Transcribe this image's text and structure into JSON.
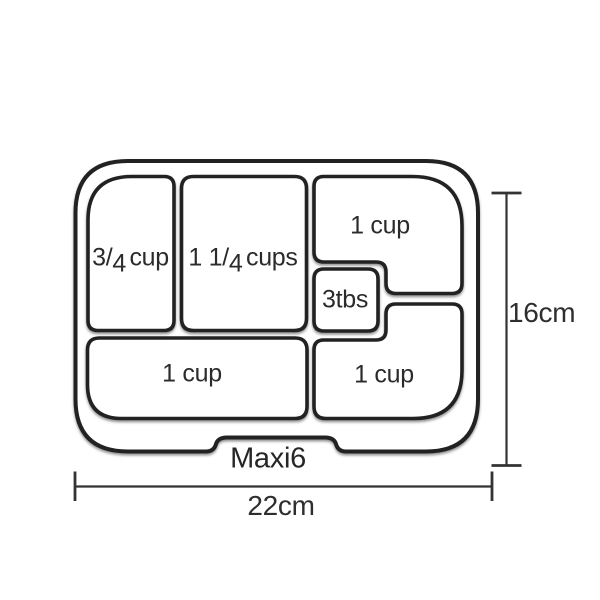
{
  "diagram": {
    "product_label": "Maxi6",
    "dimensions": {
      "width": "22cm",
      "height": "16cm"
    },
    "compartments": {
      "top_left": {
        "pre": "3",
        "slash": "/",
        "den": "4",
        "unit": "cup"
      },
      "top_middle": {
        "pre": "1 1",
        "slash": "/",
        "den": "4",
        "unit": "cups"
      },
      "top_right": {
        "label": "1 cup"
      },
      "small_center": {
        "label": "3tbs"
      },
      "bottom_left": {
        "label": "1 cup"
      },
      "bottom_right": {
        "label": "1 cup"
      }
    },
    "colors": {
      "line": "#222222",
      "dimension_line": "#333333",
      "text": "#2b2b2b",
      "background": "#ffffff"
    }
  }
}
